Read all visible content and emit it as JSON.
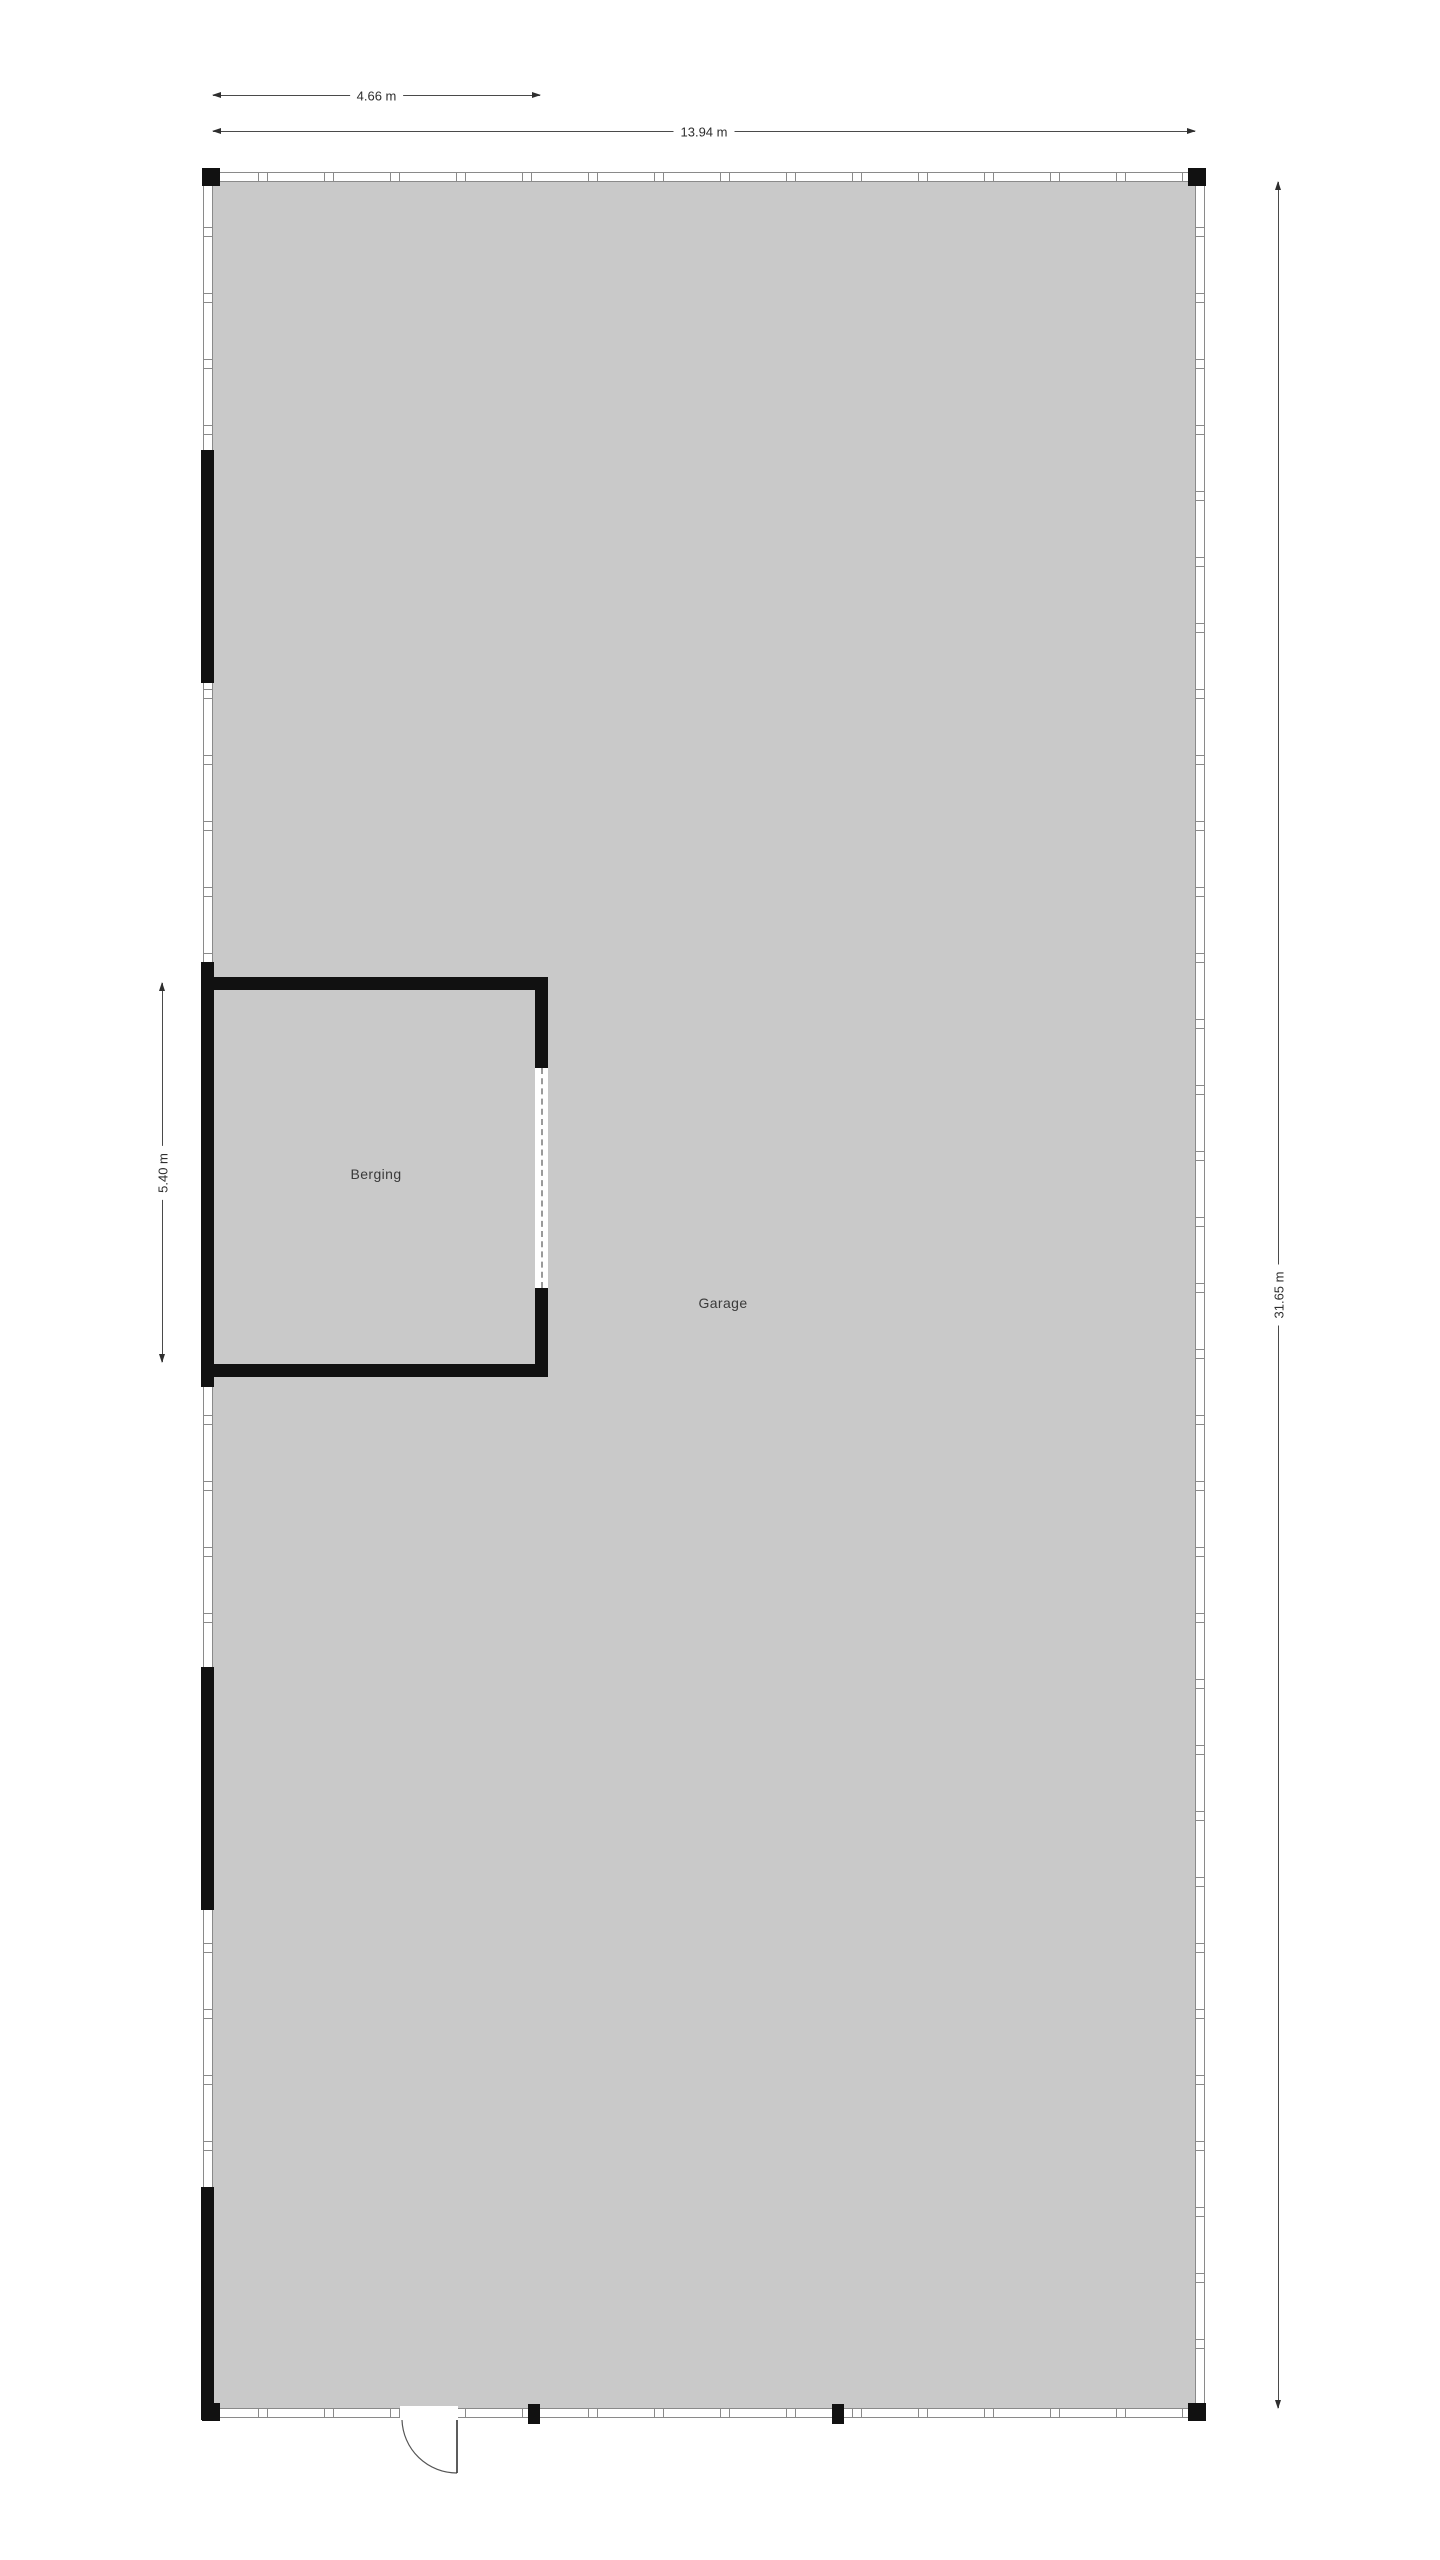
{
  "floorplan": {
    "rooms": [
      {
        "label": "Garage"
      },
      {
        "label": "Berging"
      }
    ],
    "dimensions": {
      "berging_width": {
        "label": "4.66 m",
        "orientation": "horizontal"
      },
      "total_width": {
        "label": "13.94 m",
        "orientation": "horizontal"
      },
      "berging_height": {
        "label": "5.40 m",
        "orientation": "vertical"
      },
      "total_height": {
        "label": "31.65 m",
        "orientation": "vertical"
      }
    },
    "colors": {
      "floor": "#c9c9c9",
      "wall_solid": "#111111",
      "wall_hatch_outline": "#8a8a8a",
      "dimension_line": "#4a4a4a",
      "label_text": "#3a3a3a",
      "background": "#ffffff"
    }
  }
}
